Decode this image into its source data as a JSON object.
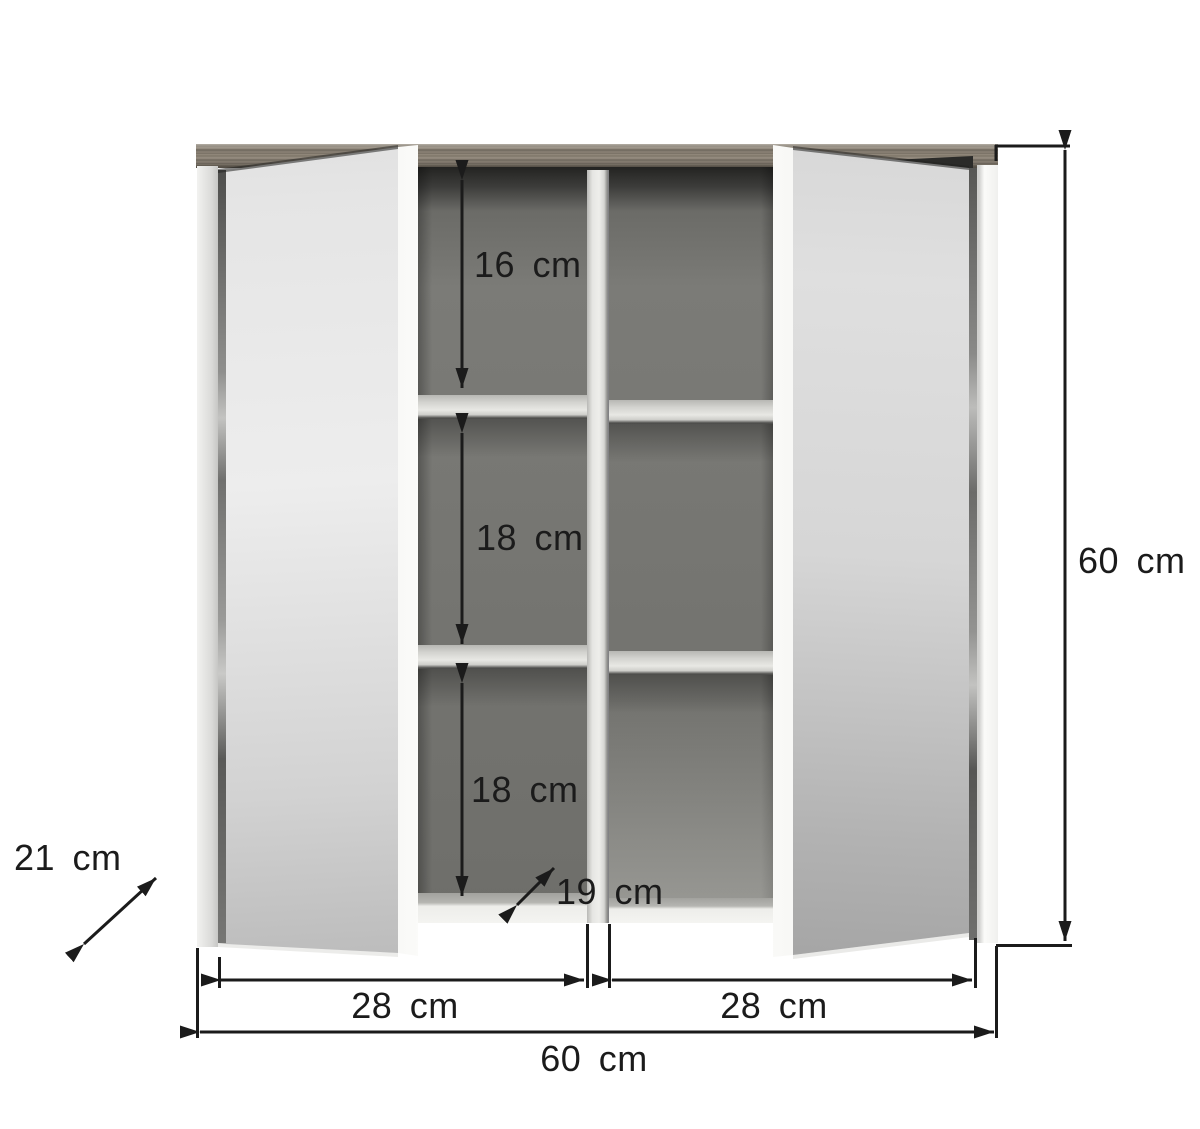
{
  "diagram": {
    "subject": "two-door mirror wall cabinet dimension drawing",
    "unit": "cm",
    "labels": {
      "top_shelf_height": "16 cm",
      "middle_shelf_height": "18 cm",
      "bottom_shelf_height": "18 cm",
      "inner_depth": "19 cm",
      "outer_depth": "21 cm",
      "left_door_width": "28 cm",
      "right_door_width": "28 cm",
      "total_width": "60 cm",
      "total_height": "60 cm"
    },
    "colors": {
      "background": "#ffffff",
      "outline": "#1b1b1b",
      "wood_top": "#877e72",
      "mirror_light": "#d6d6d6",
      "mirror_dark": "#a4a4a4",
      "carcass_white": "#fbfbf9",
      "interior_back": "#757571",
      "interior_shadow": "#232321",
      "shelf": "#d9d9d5"
    }
  }
}
